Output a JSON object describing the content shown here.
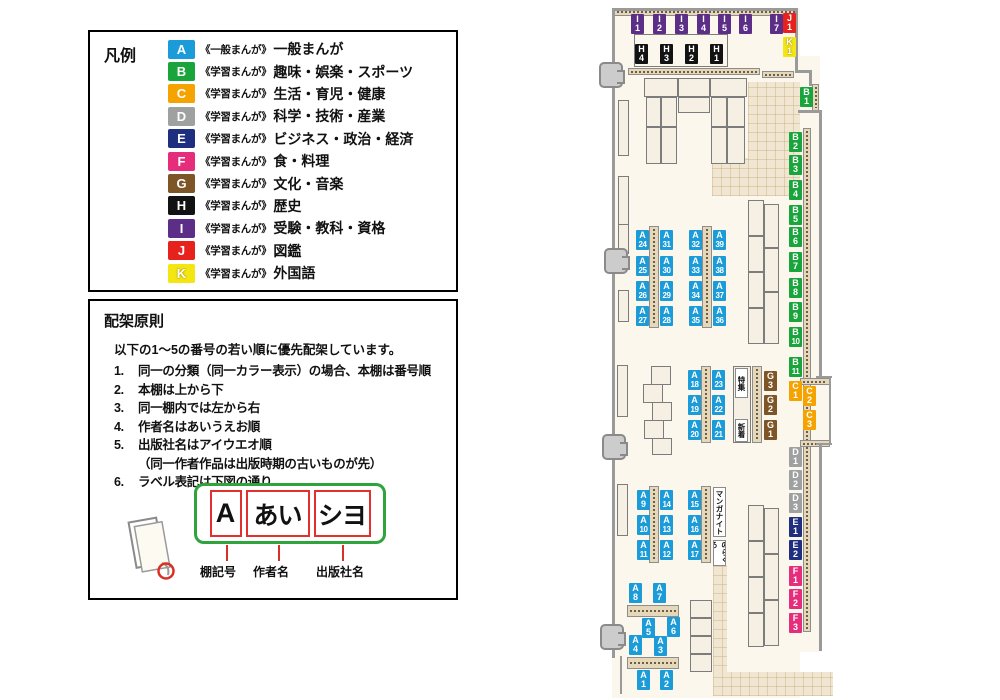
{
  "legend": {
    "title": "凡例",
    "items": [
      {
        "code": "A",
        "series": "《一般まんが》",
        "category": "一般まんが",
        "color": "#1b9cd8"
      },
      {
        "code": "B",
        "series": "《学習まんが》",
        "category": "趣味・娯楽・スポーツ",
        "color": "#19a53c"
      },
      {
        "code": "C",
        "series": "《学習まんが》",
        "category": "生活・育児・健康",
        "color": "#f5a300"
      },
      {
        "code": "D",
        "series": "《学習まんが》",
        "category": "科学・技術・産業",
        "color": "#9fa0a0"
      },
      {
        "code": "E",
        "series": "《学習まんが》",
        "category": "ビジネス・政治・経済",
        "color": "#1e2f80"
      },
      {
        "code": "F",
        "series": "《学習まんが》",
        "category": "食・料理",
        "color": "#e62d7c"
      },
      {
        "code": "G",
        "series": "《学習まんが》",
        "category": "文化・音楽",
        "color": "#7d5526"
      },
      {
        "code": "H",
        "series": "《学習まんが》",
        "category": "歴史",
        "color": "#121212"
      },
      {
        "code": "I",
        "series": "《学習まんが》",
        "category": "受験・教科・資格",
        "color": "#5c2e87"
      },
      {
        "code": "J",
        "series": "《学習まんが》",
        "category": "図鑑",
        "color": "#e7211b"
      },
      {
        "code": "K",
        "series": "《学習まんが》",
        "category": "外国語",
        "color": "#f4e613",
        "text_color": "#ffffff"
      }
    ]
  },
  "principles": {
    "title": "配架原則",
    "intro": "以下の1〜5の番号の若い順に優先配架しています。",
    "rules": [
      {
        "num": "1.",
        "text": "同一の分類（同一カラー表示）の場合、本棚は番号順"
      },
      {
        "num": "2.",
        "text": "本棚は上から下"
      },
      {
        "num": "3.",
        "text": "同一棚内では左から右"
      },
      {
        "num": "4.",
        "text": "作者名はあいうえお順"
      },
      {
        "num": "5.",
        "text": "出版社名はアイウエオ順"
      },
      {
        "num": "",
        "text": "（同一作者作品は出版時期の古いものが先）"
      },
      {
        "num": "6.",
        "text": "ラベル表記は下図の通り"
      }
    ],
    "diagram": {
      "boxes": [
        "A",
        "あい",
        "シヨ"
      ],
      "captions": [
        "棚記号",
        "作者名",
        "出版社名"
      ]
    }
  },
  "map": {
    "special_labels": [
      {
        "text": "特集",
        "x": 735,
        "y": 368,
        "h": 30
      },
      {
        "text": "新着",
        "x": 735,
        "y": 419,
        "h": 23
      },
      {
        "text": "マンガナイト",
        "x": 713,
        "y": 487,
        "h": 50
      },
      {
        "text": "のらくろ",
        "x": 713,
        "y": 540,
        "h": 26
      }
    ],
    "labels": [
      {
        "t": "I",
        "n": "1",
        "x": 631,
        "y": 14
      },
      {
        "t": "I",
        "n": "2",
        "x": 653,
        "y": 14
      },
      {
        "t": "I",
        "n": "3",
        "x": 675,
        "y": 14
      },
      {
        "t": "I",
        "n": "4",
        "x": 697,
        "y": 14
      },
      {
        "t": "I",
        "n": "5",
        "x": 718,
        "y": 14
      },
      {
        "t": "I",
        "n": "6",
        "x": 739,
        "y": 14
      },
      {
        "t": "I",
        "n": "7",
        "x": 770,
        "y": 14
      },
      {
        "t": "J",
        "n": "1",
        "x": 783,
        "y": 13
      },
      {
        "t": "K",
        "n": "1",
        "x": 783,
        "y": 37
      },
      {
        "t": "H",
        "n": "4",
        "x": 635,
        "y": 44
      },
      {
        "t": "H",
        "n": "3",
        "x": 660,
        "y": 44
      },
      {
        "t": "H",
        "n": "2",
        "x": 685,
        "y": 44
      },
      {
        "t": "H",
        "n": "1",
        "x": 710,
        "y": 44
      },
      {
        "t": "B",
        "n": "1",
        "x": 800,
        "y": 87
      },
      {
        "t": "B",
        "n": "2",
        "x": 789,
        "y": 132
      },
      {
        "t": "B",
        "n": "3",
        "x": 789,
        "y": 155
      },
      {
        "t": "B",
        "n": "4",
        "x": 789,
        "y": 180
      },
      {
        "t": "B",
        "n": "5",
        "x": 789,
        "y": 205
      },
      {
        "t": "B",
        "n": "6",
        "x": 789,
        "y": 227
      },
      {
        "t": "B",
        "n": "7",
        "x": 789,
        "y": 252
      },
      {
        "t": "B",
        "n": "8",
        "x": 789,
        "y": 278
      },
      {
        "t": "B",
        "n": "9",
        "x": 789,
        "y": 302
      },
      {
        "t": "B",
        "n": "10",
        "x": 789,
        "y": 327
      },
      {
        "t": "B",
        "n": "11",
        "x": 789,
        "y": 357
      },
      {
        "t": "C",
        "n": "1",
        "x": 789,
        "y": 381
      },
      {
        "t": "C",
        "n": "2",
        "x": 803,
        "y": 386
      },
      {
        "t": "C",
        "n": "3",
        "x": 803,
        "y": 410
      },
      {
        "t": "D",
        "n": "1",
        "x": 789,
        "y": 447
      },
      {
        "t": "D",
        "n": "2",
        "x": 789,
        "y": 470
      },
      {
        "t": "D",
        "n": "3",
        "x": 789,
        "y": 493
      },
      {
        "t": "E",
        "n": "1",
        "x": 789,
        "y": 517
      },
      {
        "t": "E",
        "n": "2",
        "x": 789,
        "y": 540
      },
      {
        "t": "F",
        "n": "1",
        "x": 789,
        "y": 566
      },
      {
        "t": "F",
        "n": "2",
        "x": 789,
        "y": 589
      },
      {
        "t": "F",
        "n": "3",
        "x": 789,
        "y": 613
      },
      {
        "t": "A",
        "n": "24",
        "x": 636,
        "y": 230
      },
      {
        "t": "A",
        "n": "25",
        "x": 636,
        "y": 256
      },
      {
        "t": "A",
        "n": "26",
        "x": 636,
        "y": 281
      },
      {
        "t": "A",
        "n": "27",
        "x": 636,
        "y": 306
      },
      {
        "t": "A",
        "n": "31",
        "x": 660,
        "y": 230
      },
      {
        "t": "A",
        "n": "30",
        "x": 660,
        "y": 256
      },
      {
        "t": "A",
        "n": "29",
        "x": 660,
        "y": 281
      },
      {
        "t": "A",
        "n": "28",
        "x": 660,
        "y": 306
      },
      {
        "t": "A",
        "n": "32",
        "x": 689,
        "y": 230
      },
      {
        "t": "A",
        "n": "33",
        "x": 689,
        "y": 256
      },
      {
        "t": "A",
        "n": "34",
        "x": 689,
        "y": 281
      },
      {
        "t": "A",
        "n": "35",
        "x": 689,
        "y": 306
      },
      {
        "t": "A",
        "n": "39",
        "x": 713,
        "y": 230
      },
      {
        "t": "A",
        "n": "38",
        "x": 713,
        "y": 256
      },
      {
        "t": "A",
        "n": "37",
        "x": 713,
        "y": 281
      },
      {
        "t": "A",
        "n": "36",
        "x": 713,
        "y": 306
      },
      {
        "t": "A",
        "n": "18",
        "x": 688,
        "y": 370
      },
      {
        "t": "A",
        "n": "19",
        "x": 688,
        "y": 395
      },
      {
        "t": "A",
        "n": "20",
        "x": 688,
        "y": 420
      },
      {
        "t": "A",
        "n": "23",
        "x": 712,
        "y": 370
      },
      {
        "t": "A",
        "n": "22",
        "x": 712,
        "y": 395
      },
      {
        "t": "A",
        "n": "21",
        "x": 712,
        "y": 420
      },
      {
        "t": "G",
        "n": "3",
        "x": 764,
        "y": 371
      },
      {
        "t": "G",
        "n": "2",
        "x": 764,
        "y": 395
      },
      {
        "t": "G",
        "n": "1",
        "x": 764,
        "y": 420
      },
      {
        "t": "A",
        "n": "9",
        "x": 637,
        "y": 490
      },
      {
        "t": "A",
        "n": "10",
        "x": 637,
        "y": 515
      },
      {
        "t": "A",
        "n": "11",
        "x": 637,
        "y": 540
      },
      {
        "t": "A",
        "n": "14",
        "x": 660,
        "y": 490
      },
      {
        "t": "A",
        "n": "13",
        "x": 660,
        "y": 515
      },
      {
        "t": "A",
        "n": "12",
        "x": 660,
        "y": 540
      },
      {
        "t": "A",
        "n": "15",
        "x": 688,
        "y": 490
      },
      {
        "t": "A",
        "n": "16",
        "x": 688,
        "y": 515
      },
      {
        "t": "A",
        "n": "17",
        "x": 688,
        "y": 540
      },
      {
        "t": "A",
        "n": "8",
        "x": 629,
        "y": 583
      },
      {
        "t": "A",
        "n": "7",
        "x": 653,
        "y": 583
      },
      {
        "t": "A",
        "n": "5",
        "x": 642,
        "y": 618
      },
      {
        "t": "A",
        "n": "6",
        "x": 667,
        "y": 617
      },
      {
        "t": "A",
        "n": "4",
        "x": 629,
        "y": 635
      },
      {
        "t": "A",
        "n": "3",
        "x": 654,
        "y": 636
      },
      {
        "t": "A",
        "n": "1",
        "x": 637,
        "y": 670
      },
      {
        "t": "A",
        "n": "2",
        "x": 660,
        "y": 670
      }
    ]
  }
}
